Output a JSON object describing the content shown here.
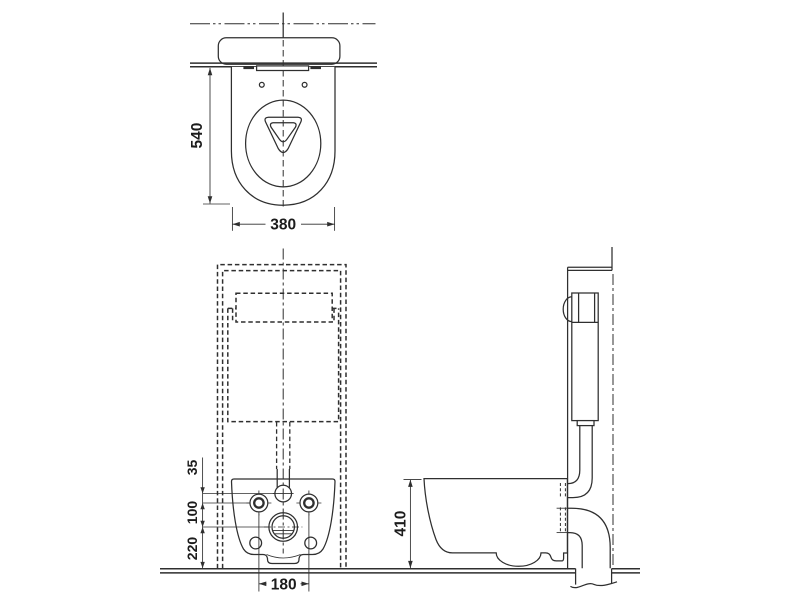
{
  "meta": {
    "background": "#ffffff",
    "line_color": "#2f2f2f",
    "text_color": "#1c1c1c",
    "drawing_type": "wall-hung toilet installation dimension diagram"
  },
  "views": {
    "top": {
      "dims": {
        "depth": "540",
        "width": "380"
      }
    },
    "front": {
      "dims": {
        "inlet_to_bolts": "35",
        "bolts_to_drain": "100",
        "drain_to_floor": "220",
        "bolt_spacing": "180"
      }
    },
    "side": {
      "dims": {
        "rim_height": "410"
      }
    }
  }
}
